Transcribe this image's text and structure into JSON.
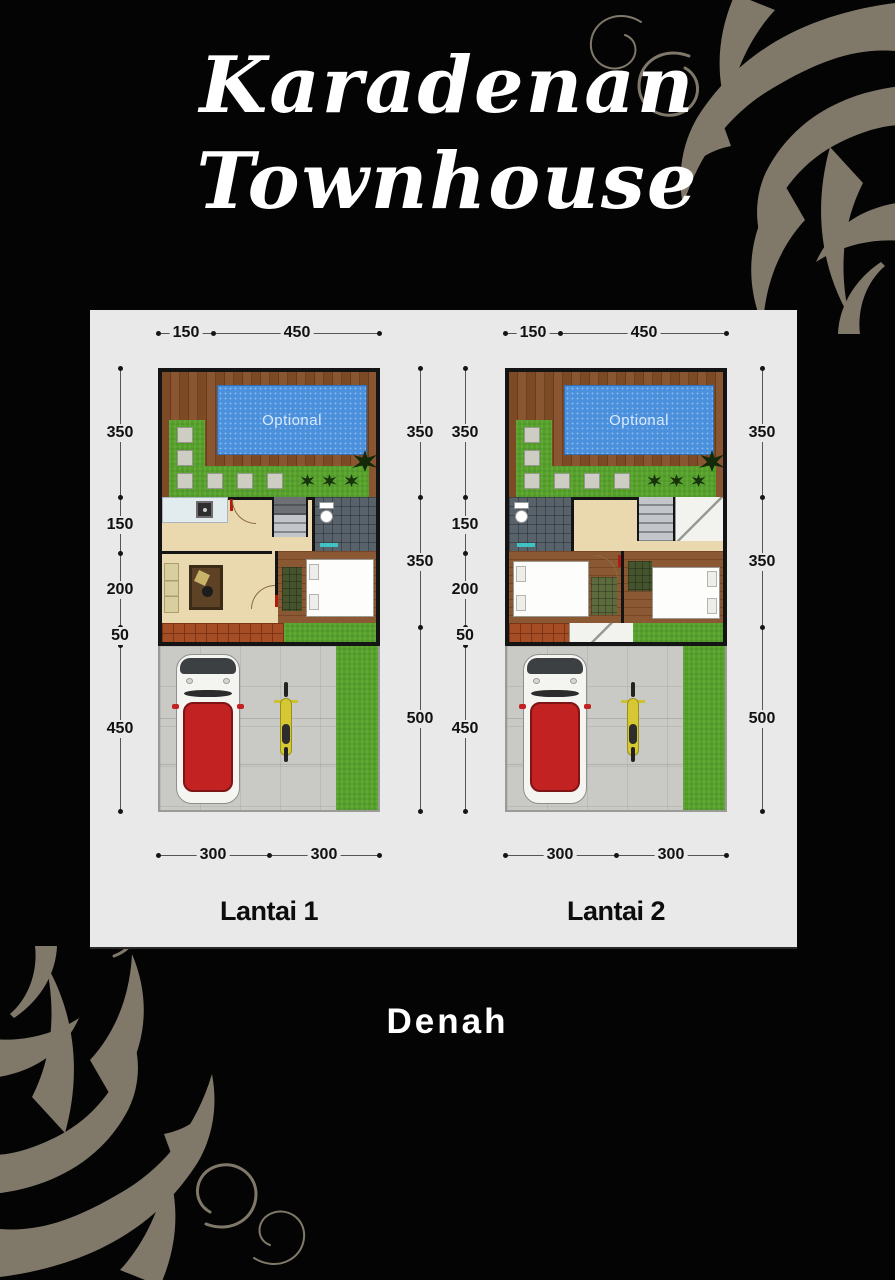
{
  "poster": {
    "title_line1": "Karadenan",
    "title_line2": "Townhouse",
    "caption": "Denah"
  },
  "colors": {
    "background": "#040404",
    "panel": "#e9e9e9",
    "ornament": "#867e6f",
    "pool_water": "#4a90dd",
    "deck_wood": "#7c4a25",
    "grass": "#55a129",
    "car_roof_red": "#c32222",
    "motorcycle_yellow": "#d6c832",
    "dimension_text": "#111111",
    "title_text": "#ffffff"
  },
  "plans": [
    {
      "name": "Lantai 1",
      "pool_label": "Optional",
      "top_dims": [
        "150",
        "450"
      ],
      "left_dims": [
        "350",
        "150",
        "200",
        "50",
        "450"
      ],
      "right_dims": [
        "350",
        "350",
        "500"
      ],
      "bottom_dims": [
        "300",
        "300"
      ]
    },
    {
      "name": "Lantai 2",
      "pool_label": "Optional",
      "top_dims": [
        "150",
        "450"
      ],
      "left_dims": [
        "350",
        "150",
        "200",
        "50",
        "450"
      ],
      "right_dims": [
        "350",
        "350",
        "500"
      ],
      "bottom_dims": [
        "300",
        "300"
      ]
    }
  ]
}
